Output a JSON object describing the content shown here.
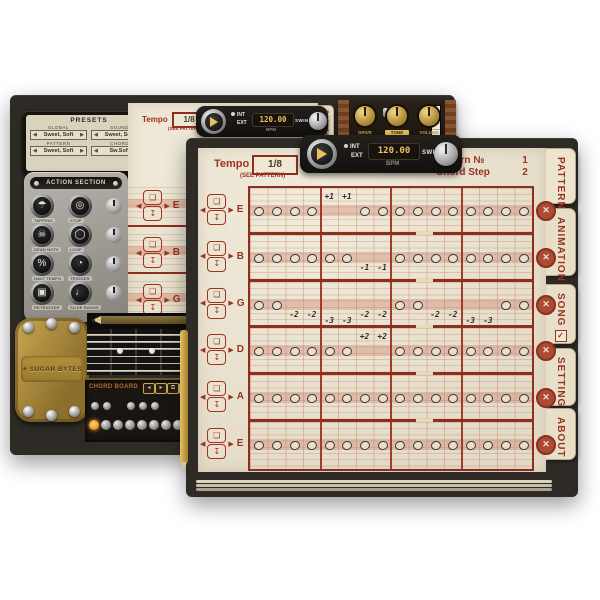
{
  "front": {
    "header": {
      "tempo_label": "Tempo",
      "tempo_value": "1/8",
      "tempo_note": "(SEE PATTERN)",
      "pattern_no_label": "Pattern №",
      "pattern_no_value": "1",
      "chord_step_label": "Chord Step",
      "chord_step_value": "2"
    },
    "transport": {
      "int_label": "INT",
      "ext_label": "EXT",
      "bpm_value": "120.00",
      "bpm_label": "BPM",
      "swing_label": "SWING"
    },
    "tabs": [
      {
        "label": "PATTERN",
        "active": true
      },
      {
        "label": "ANIMATION",
        "active": false
      },
      {
        "label": "SONG",
        "active": false,
        "checkbox": true,
        "checked": true
      },
      {
        "label": "SETTINGS",
        "active": false
      },
      {
        "label": "ABOUT",
        "active": false
      }
    ],
    "rows": [
      {
        "label": "E",
        "steps": [
          "o",
          "o",
          "o",
          "o",
          "+1|a",
          "+1|a",
          "o",
          "o",
          "o",
          "o",
          "o",
          "o",
          "o",
          "o",
          "o",
          "o"
        ]
      },
      {
        "label": "B",
        "steps": [
          "o",
          "o",
          "o",
          "o",
          "o",
          "o",
          "-1|b1",
          "-1|b1",
          "o",
          "o",
          "o",
          "o",
          "o",
          "o",
          "o",
          "o"
        ]
      },
      {
        "label": "G",
        "steps": [
          "o",
          "o",
          "-2|b1",
          "-2|b1",
          "-3|b2",
          "-3|b2",
          "-2|b1",
          "-2|b1",
          "o",
          "o",
          "-2|b1",
          "-2|b1",
          "-3|b2",
          "-3|b2",
          "o",
          "o"
        ]
      },
      {
        "label": "D",
        "steps": [
          "o",
          "o",
          "o",
          "o",
          "o",
          "o",
          "+2|a",
          "+2|a",
          "o",
          "o",
          "o",
          "o",
          "o",
          "o",
          "o",
          "o"
        ]
      },
      {
        "label": "A",
        "steps": [
          "o",
          "o",
          "o",
          "o",
          "o",
          "o",
          "o",
          "o",
          "o",
          "o",
          "o",
          "o",
          "o",
          "o",
          "o",
          "o"
        ]
      },
      {
        "label": "E",
        "steps": [
          "o",
          "o",
          "o",
          "o",
          "o",
          "o",
          "o",
          "o",
          "o",
          "o",
          "o",
          "o",
          "o",
          "o",
          "o",
          "o"
        ]
      }
    ],
    "mute_glyph": "✕"
  },
  "background": {
    "presets": {
      "title": "PRESETS",
      "fields": [
        {
          "label": "GLOBAL",
          "value": "Sweet, Soft"
        },
        {
          "label": "SOUND",
          "value": "Sweet, Soft"
        },
        {
          "label": "PATTERN",
          "value": "Sweet, Soft"
        },
        {
          "label": "CHORD",
          "value": "Sw.Soft"
        }
      ]
    },
    "action_section": {
      "title": "ACTION SECTION",
      "rows": [
        {
          "left": {
            "name": "hat-icon",
            "glyph": "☂",
            "label": "TAPPING"
          },
          "right": {
            "name": "stop-icon",
            "glyph": "◎",
            "label": "STOP"
          }
        },
        {
          "left": {
            "name": "skull-icon",
            "glyph": "☠",
            "label": "DEAD NOTE"
          },
          "right": {
            "name": "loop-icon",
            "glyph": "◯",
            "label": "LOOP"
          }
        },
        {
          "left": {
            "name": "percent-icon",
            "glyph": "%",
            "label": "HALF TEMPO"
          },
          "right": {
            "name": "eye-icon",
            "glyph": "◔",
            "label": "TRIGGER"
          }
        },
        {
          "left": {
            "name": "square-icon",
            "glyph": "▣",
            "label": "RETRIGGER"
          },
          "right": {
            "name": "bell-icon",
            "glyph": "♩",
            "label": "SLIDE RANGE"
          }
        }
      ]
    },
    "amp": {
      "knobs": [
        "DRIVE",
        "TONE",
        "VOLUME"
      ],
      "highlight": "TONE"
    },
    "header": {
      "tempo_label": "Tempo",
      "tempo_value": "1/8",
      "tempo_note": "(SEE PATTERN)",
      "pattern_no_label": "Pattern №",
      "pattern_no_value": "2",
      "chord_step_label": "Chord Step",
      "chord_step_value": "2"
    },
    "transport": {
      "int_label": "INT",
      "ext_label": "EXT",
      "bpm_value": "120.00",
      "bpm_label": "BPM",
      "swing_label": "SWING"
    },
    "tab_label": "PATTERN",
    "logo_text": "SUGAR BYTES",
    "logo_star": "✦",
    "chord_board": {
      "label": "CHORD BOARD",
      "mini_buttons": [
        "◂",
        "▸",
        "⧉",
        "⊕"
      ]
    },
    "row_stub_labels": [
      "E",
      "B",
      "G",
      "D"
    ]
  },
  "colors": {
    "paper": "#ece4cf",
    "frame": "#2e2a25",
    "grid_red": "#8e2e1f",
    "text_red": "#9c3222",
    "lcd_amber": "#eac169",
    "gold": "#caa84c",
    "lit_amber": "#f09a2e"
  }
}
